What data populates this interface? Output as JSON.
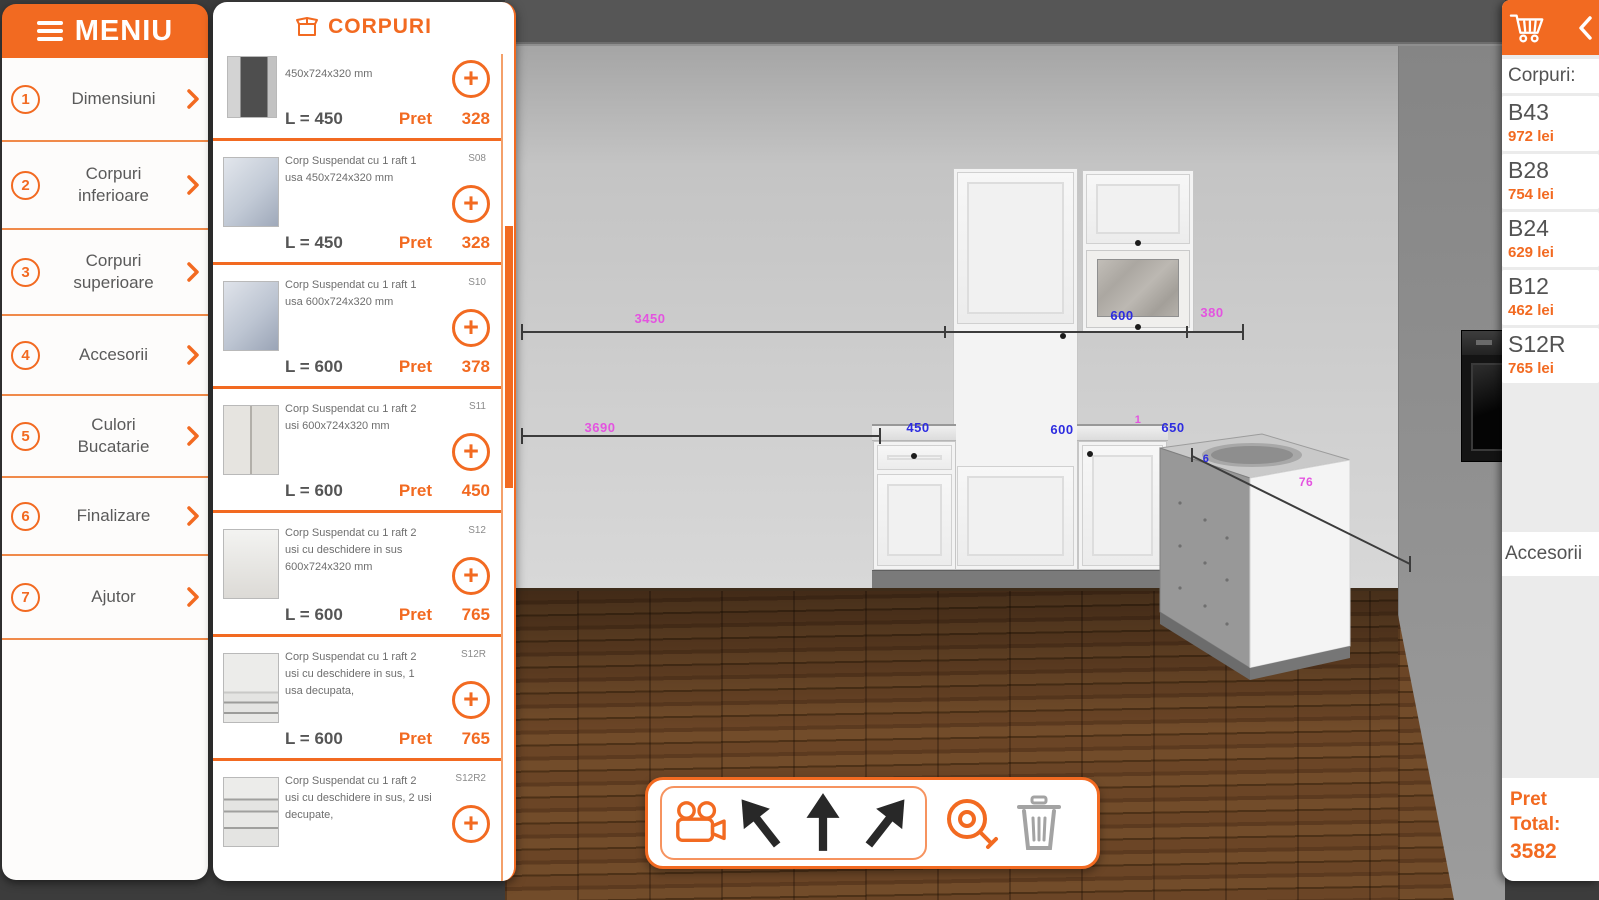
{
  "colors": {
    "accent": "#f26a21",
    "dim_magenta": "#e453e0",
    "dim_blue": "#2d2ce0"
  },
  "icons": [
    "hamburger-icon",
    "chevron-right-icon",
    "box-icon",
    "plus-circle-icon",
    "cart-icon",
    "chevron-left-icon",
    "video-camera-icon",
    "arrow-up-left-icon",
    "arrow-up-icon",
    "arrow-up-right-icon",
    "measure-tape-icon",
    "trash-icon"
  ],
  "menu": {
    "title": "MENIU",
    "items": [
      {
        "num": "1",
        "label": "Dimensiuni"
      },
      {
        "num": "2",
        "label": "Corpuri inferioare"
      },
      {
        "num": "3",
        "label": "Corpuri superioare"
      },
      {
        "num": "4",
        "label": "Accesorii"
      },
      {
        "num": "5",
        "label": "Culori Bucatarie"
      },
      {
        "num": "6",
        "label": "Finalizare"
      },
      {
        "num": "7",
        "label": "Ajutor"
      }
    ]
  },
  "catalog": {
    "title": "CORPURI",
    "pret_label": "Pret",
    "items": [
      {
        "desc": "450x724x320 mm",
        "code": "",
        "len": "L = 450",
        "price": "328"
      },
      {
        "desc": "Corp Suspendat cu 1 raft 1 usa 450x724x320 mm",
        "code": "S08",
        "len": "L = 450",
        "price": "328"
      },
      {
        "desc": "Corp Suspendat cu 1 raft 1 usa 600x724x320 mm",
        "code": "S10",
        "len": "L = 600",
        "price": "378"
      },
      {
        "desc": "Corp Suspendat cu 1 raft 2 usi 600x724x320 mm",
        "code": "S11",
        "len": "L = 600",
        "price": "450"
      },
      {
        "desc": "Corp Suspendat cu 1 raft 2 usi cu deschidere in sus 600x724x320 mm",
        "code": "S12",
        "len": "L = 600",
        "price": "765"
      },
      {
        "desc": "Corp Suspendat cu 1 raft 2 usi cu deschidere in sus, 1 usa decupata,",
        "code": "S12R",
        "len": "L = 600",
        "price": "765"
      },
      {
        "desc": "Corp Suspendat cu 1 raft 2 usi cu deschidere in sus, 2 usi decupate,",
        "code": "S12R2",
        "len": "",
        "price": ""
      }
    ]
  },
  "cart": {
    "section_title": "Corpuri:",
    "items": [
      {
        "name": "B43",
        "price": "972 lei"
      },
      {
        "name": "B28",
        "price": "754 lei"
      },
      {
        "name": "B24",
        "price": "629 lei"
      },
      {
        "name": "B12",
        "price": "462 lei"
      },
      {
        "name": "S12R",
        "price": "765 lei"
      }
    ],
    "accessories_label": "Accesorii",
    "total": {
      "line1": "Pret",
      "line2": "Total:",
      "value": "3582"
    }
  },
  "scene": {
    "dims": {
      "top_total": "3450",
      "top_wall_cab": "600",
      "top_gap": "380",
      "bottom_total": "3690",
      "base_left": "450",
      "oven_width": "600",
      "gap_one": "1",
      "corner_width": "650",
      "corner_small": "6",
      "corner_diag": "76"
    }
  }
}
